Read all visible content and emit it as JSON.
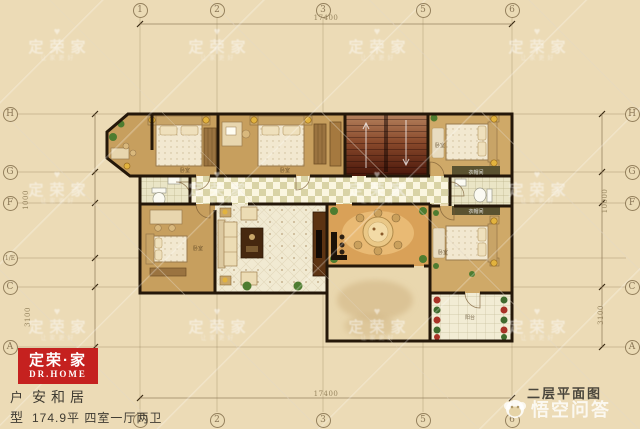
{
  "title": "二层平面图",
  "logo": {
    "cn": "定荣·家",
    "en": "DR.HOME"
  },
  "footer": {
    "label_top": "户",
    "label_bottom": "型",
    "name": "安和居",
    "spec": "174.9平 四室一厅两卫"
  },
  "qa_watermark": {
    "text": "悟空问答"
  },
  "brand_watermark": {
    "heart": "♥",
    "brand": "定荣家",
    "tagline": "让家更好",
    "positions": [
      {
        "x": 57,
        "y": 45
      },
      {
        "x": 217,
        "y": 45
      },
      {
        "x": 377,
        "y": 45
      },
      {
        "x": 537,
        "y": 45
      },
      {
        "x": 57,
        "y": 188
      },
      {
        "x": 217,
        "y": 188
      },
      {
        "x": 377,
        "y": 188
      },
      {
        "x": 537,
        "y": 188
      },
      {
        "x": 57,
        "y": 325
      },
      {
        "x": 217,
        "y": 325
      },
      {
        "x": 377,
        "y": 325
      },
      {
        "x": 537,
        "y": 325
      }
    ]
  },
  "axes": {
    "top": [
      {
        "label": "1",
        "x": 140
      },
      {
        "label": "2",
        "x": 217
      },
      {
        "label": "3",
        "x": 323
      },
      {
        "label": "5",
        "x": 423
      },
      {
        "label": "6",
        "x": 512
      }
    ],
    "bottom": [
      {
        "label": "1",
        "x": 140
      },
      {
        "label": "2",
        "x": 217
      },
      {
        "label": "3",
        "x": 323
      },
      {
        "label": "5",
        "x": 423
      },
      {
        "label": "6",
        "x": 512
      }
    ],
    "left": [
      {
        "label": "H",
        "y": 114
      },
      {
        "label": "G",
        "y": 172
      },
      {
        "label": "F",
        "y": 203
      },
      {
        "label": "1/E",
        "y": 258
      },
      {
        "label": "C",
        "y": 287
      },
      {
        "label": "A",
        "y": 347
      }
    ],
    "right": [
      {
        "label": "H",
        "y": 114
      },
      {
        "label": "G",
        "y": 172
      },
      {
        "label": "F",
        "y": 203
      },
      {
        "label": "C",
        "y": 287
      },
      {
        "label": "A",
        "y": 347
      }
    ]
  },
  "dimensions": {
    "top": "17400",
    "bottom": "17400",
    "left_upper": "1000",
    "left_lower": "3100",
    "right_upper": "10000",
    "right_lower": "3100"
  },
  "room_labels": {
    "bedroom": "卧室",
    "balcony": "阳台",
    "closet": "衣帽间"
  },
  "colors": {
    "background": "#ecdbb6",
    "logo_red": "#c5211f",
    "wall": "#241709",
    "wood_floor": "#c79f5e",
    "stair_dark": "#49160a",
    "dining_floor": "#d9a158"
  }
}
